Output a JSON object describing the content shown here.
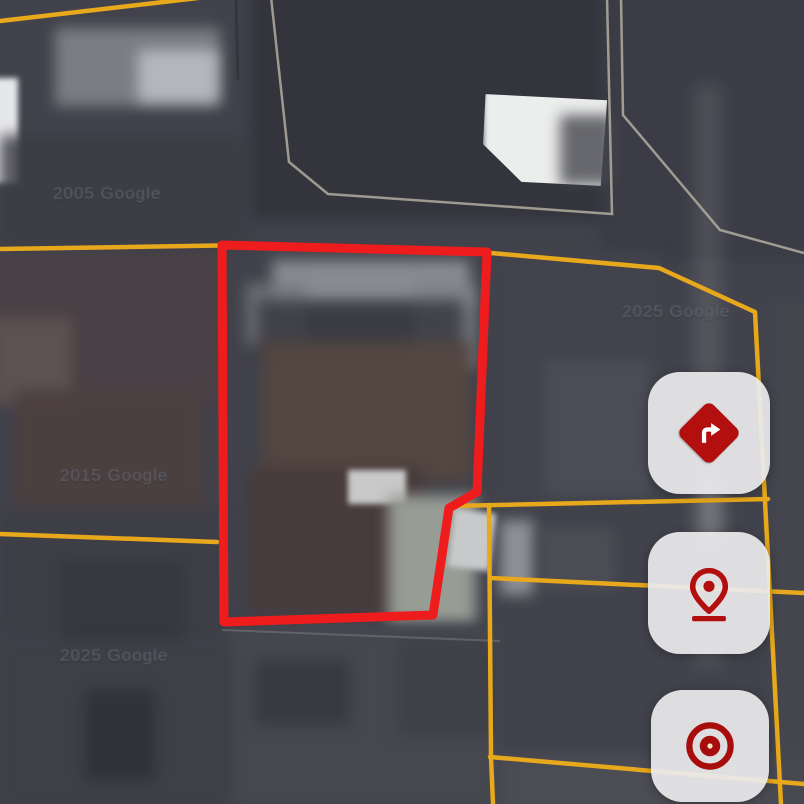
{
  "map": {
    "type": "satellite",
    "watermarks": [
      {
        "text": "2005 Google"
      },
      {
        "text": "2025 Google"
      },
      {
        "text": "2015 Google"
      },
      {
        "text": "2025 Google"
      }
    ],
    "colors": {
      "highlight_parcel": "#ee1c1c",
      "parcel_line": "#e7a81b",
      "survey_line": "#b3ada0",
      "button_bg": "#ebecee",
      "button_icon_red": "#b30f0f"
    }
  },
  "controls": {
    "buttons": [
      {
        "name": "directions",
        "icon": "turn-right-diamond-icon"
      },
      {
        "name": "location-pin",
        "icon": "map-pin-icon"
      },
      {
        "name": "recenter-target",
        "icon": "bullseye-icon"
      }
    ]
  }
}
